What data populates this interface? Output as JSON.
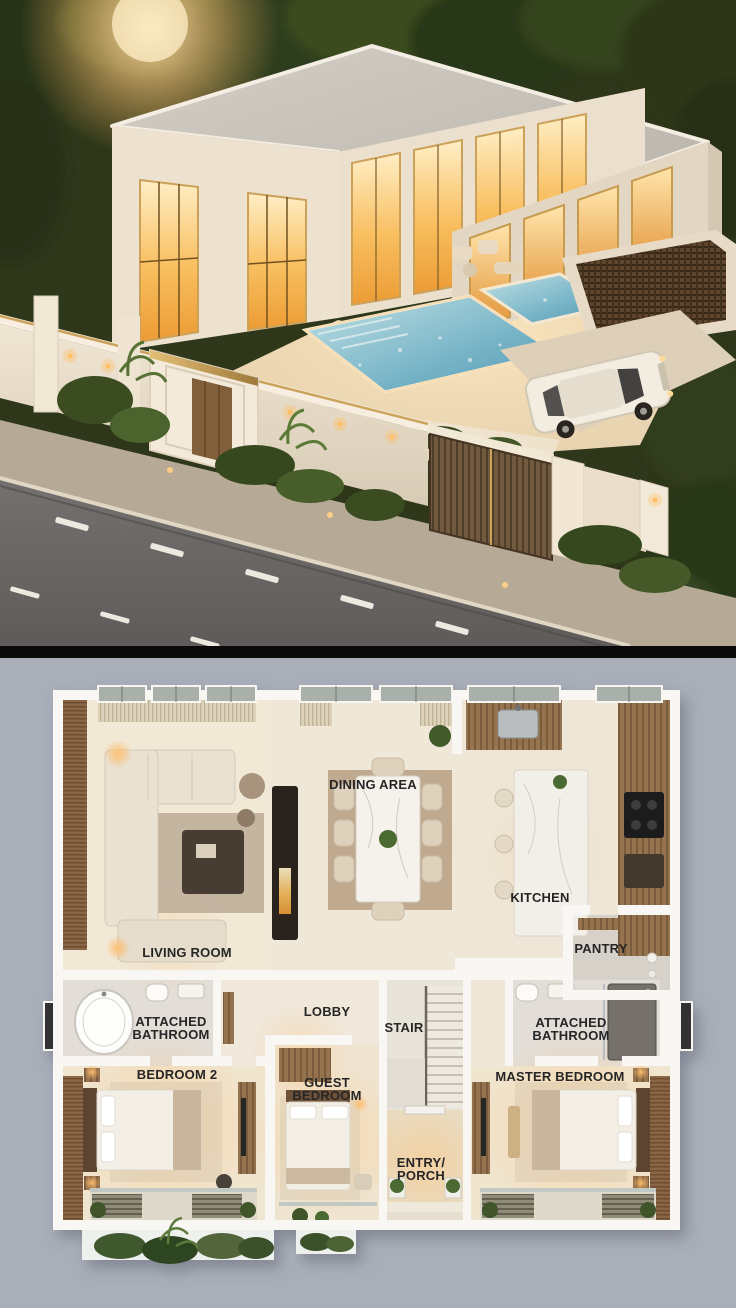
{
  "palette": {
    "divider": "#0a0a0a",
    "plan_background": "#a9aeb8",
    "plan_floor": "#ece4d6",
    "plan_wall": "#f9f7f3",
    "label_color": "#262626",
    "accent_gold": "#c9a45c",
    "window_glow": "#f2a53e",
    "pool_blue": "#6fb6d2",
    "wood": "#8a6a4c",
    "greenery": "#3c5227",
    "road": "#65676b"
  },
  "exterior_scene": {
    "elements": [
      "villa",
      "glowing-windows",
      "swimming-pool",
      "pergola",
      "luxury-car",
      "boundary-wall",
      "entry-door",
      "driveway-gate",
      "road",
      "garden",
      "sun-glare"
    ]
  },
  "floor_plan": {
    "rooms": [
      {
        "id": "living-room",
        "label_lines": [
          "LIVING ROOM"
        ]
      },
      {
        "id": "dining-area",
        "label_lines": [
          "DINING AREA"
        ]
      },
      {
        "id": "kitchen",
        "label_lines": [
          "KITCHEN"
        ]
      },
      {
        "id": "pantry",
        "label_lines": [
          "PANTRY"
        ]
      },
      {
        "id": "attached-bathroom-left",
        "label_lines": [
          "ATTACHED",
          "BATHROOM"
        ]
      },
      {
        "id": "lobby",
        "label_lines": [
          "LOBBY"
        ]
      },
      {
        "id": "stair",
        "label_lines": [
          "STAIR"
        ]
      },
      {
        "id": "attached-bathroom-right",
        "label_lines": [
          "ATTACHED",
          "BATHROOM"
        ]
      },
      {
        "id": "bedroom-2",
        "label_lines": [
          "BEDROOM 2"
        ]
      },
      {
        "id": "guest-bedroom",
        "label_lines": [
          "GUEST",
          "BEDROOM"
        ]
      },
      {
        "id": "master-bedroom",
        "label_lines": [
          "MASTER BEDROOM"
        ]
      },
      {
        "id": "entry-porch",
        "label_lines": [
          "ENTRY/",
          "PORCH"
        ]
      }
    ]
  }
}
